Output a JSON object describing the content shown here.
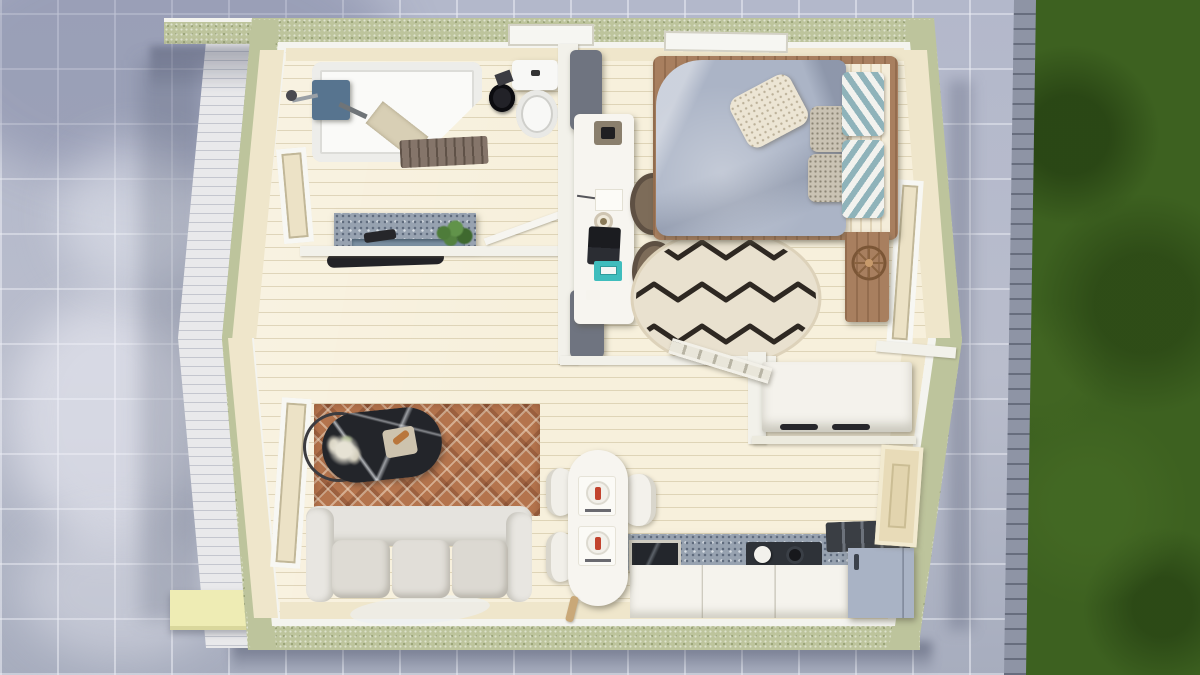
{
  "meta": {
    "title": "Tiny house interior — top-down 3D floor-plan render",
    "view": "top-down aerial",
    "style": "photorealistic architectural visualization",
    "text_on_image": "none"
  },
  "palette": {
    "grass": "#3d6120",
    "pavement": "#b6bbcb",
    "paver_edging": "#8e94a5",
    "exterior_wall_sage": "#bdc49c",
    "trim_white": "#f4f4ef",
    "floor_cream": "#f7f0dc",
    "interior_wall_cream": "#efe6cb",
    "duvet_grey_blue": "#abb4c6",
    "bed_frame_wood": "#a87f5f",
    "bedroom_rug_cream": "#e9e1cf",
    "living_rug_terracotta": "#b4744d",
    "sofa_light_grey": "#e0ddd7",
    "counter_granite": "#97a2b0",
    "fridge_body": "#a9b3c5",
    "fridge_top": "#3a3e44",
    "notebook_teal": "#3fbdbd",
    "office_chair_brown": "#6b5b4b",
    "marble_table_black": "#23252a",
    "shower_panel_blue": "#57748f",
    "platform_yellow": "#eeecb4"
  },
  "environment": {
    "ground_left": "stone tile pavement",
    "ground_right": "grass lawn",
    "edge_strip": "small paver edging",
    "walkway": "white plank deck along left wall",
    "platform": "pale yellow step platform at lower-left corner",
    "shadow": "building shadow cast on pavement below"
  },
  "rooms": {
    "bathroom": {
      "label": "Bathroom (top left)",
      "items": [
        "bathtub with corner seat",
        "wooden duckboard mat",
        "wall shower panel",
        "shower head",
        "toilet",
        "toilet brush set",
        "granite vanity counter",
        "sink basin",
        "faucet",
        "potted plant",
        "black floor mat",
        "wall window",
        "glass door ajar",
        "skylight window"
      ]
    },
    "bedroom": {
      "label": "Bedroom (top right)",
      "items": [
        "double bed with wood frame",
        "grey duvet",
        "striped sheet",
        "chevron pillows x2",
        "patterned pillows x2",
        "cream pillow",
        "round zigzag rug",
        "wooden bench",
        "rattan wheel decor",
        "side window",
        "top window"
      ]
    },
    "workspace": {
      "label": "Desk nook (center partition)",
      "items": [
        "white desk",
        "overhead grey cabinet x2",
        "phone organizer",
        "paper stack",
        "pen",
        "desk lamp",
        "laptop",
        "teal notebook",
        "office chair x2"
      ]
    },
    "living_room": {
      "label": "Living room (bottom left)",
      "items": [
        "three-seat sofa",
        "terracotta diamond-pattern rug",
        "oval black-marble coffee table",
        "serving tray",
        "pampas plant in ring stand",
        "tall wall window",
        "light floor hide"
      ]
    },
    "dining": {
      "label": "Dining nook (bottom center)",
      "items": [
        "oval white table",
        "place setting x2",
        "curved chair x2 left",
        "curved chair x1 right",
        "small wooden mallet"
      ]
    },
    "kitchen": {
      "label": "Kitchen (bottom right)",
      "items": [
        "granite countertop",
        "glass-front appliance",
        "gas hob with kettle",
        "white base cabinets",
        "fridge with dark vent top",
        "entry door"
      ]
    },
    "circulation": {
      "label": "Loft access (middle right)",
      "items": [
        "horizontal railing",
        "leaning loft ladder",
        "support post",
        "wardrobe with sliding doors and black handles",
        "lower shelf"
      ]
    }
  }
}
